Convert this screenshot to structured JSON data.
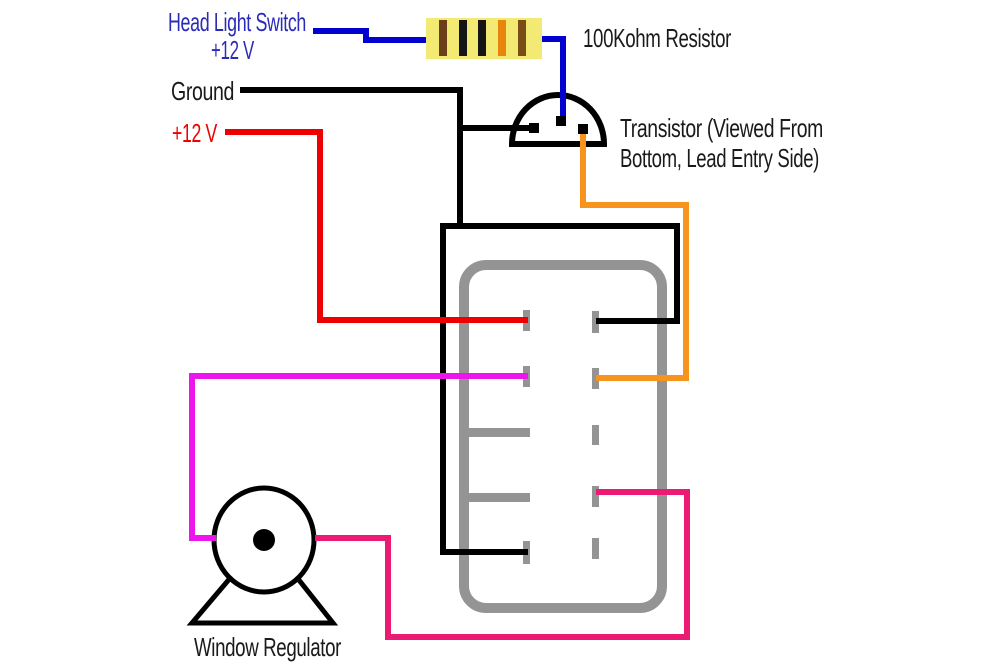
{
  "diagram": {
    "type": "automotive-wiring-diagram",
    "background": "#FFFFFF",
    "labels": {
      "head_light_switch_line1": "Head Light Switch",
      "head_light_switch_line2": "+12 V",
      "ground": "Ground",
      "supply_12v": "+12 V",
      "resistor_label": "100Kohm Resistor",
      "transistor_line1": "Transistor (Viewed From",
      "transistor_line2": "Bottom, Lead Entry Side)",
      "window_regulator": "Window Regulator"
    },
    "colors": {
      "blue_wire": "#0202D0",
      "blue_text": "#2B2BB8",
      "black": "#000000",
      "text": "#1A1A1A",
      "red": "#EE0000",
      "orange": "#F7941D",
      "magenta": "#EC15EC",
      "pink": "#EB1A72",
      "gray": "#949494",
      "white": "#FFFFFF"
    },
    "resistor": {
      "body_color": "#F3EA74",
      "band_names": [
        "brown",
        "black",
        "black",
        "orange",
        "brown"
      ],
      "band_colors": [
        "#6B4018",
        "#151515",
        "#151515",
        "#E8860B",
        "#7A4D17"
      ]
    },
    "connector": {
      "left_pin_count": 5,
      "right_pin_count": 5
    },
    "transistor": {
      "lead_count": 3
    }
  }
}
